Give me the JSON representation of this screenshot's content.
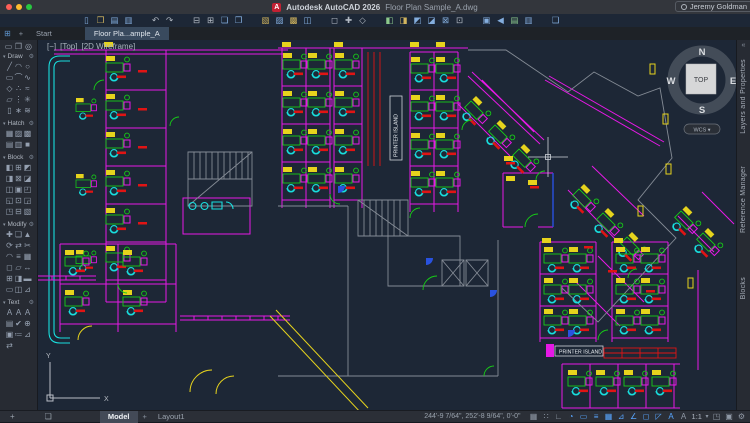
{
  "colors": {
    "titlebar": "#33363c",
    "tabbar": "#1e2227",
    "panel": "#272b33",
    "statusbar": "#2b2f37",
    "canvas": "#1d2736",
    "magenta": "#e619e6",
    "cyan": "#19dede",
    "green": "#17cd17",
    "red": "#e01414",
    "yellow": "#e6d31d",
    "blue": "#2952e0",
    "gray-wall": "#848b95",
    "accent": "#58a6ff"
  },
  "titlebar": {
    "logo_glyph": "A",
    "app_title": "Autodesk AutoCAD 2026",
    "doc_title": "Floor Plan Sample_A.dwg",
    "user": "Jeremy Goldman"
  },
  "quick_toolbar": {
    "icons": [
      {
        "name": "new-file-icon",
        "glyph": "▯",
        "tint": "b"
      },
      {
        "name": "open-folder-icon",
        "glyph": "❒",
        "tint": "y"
      },
      {
        "name": "save-icon",
        "glyph": "▤",
        "tint": "b"
      },
      {
        "name": "save-as-icon",
        "glyph": "▥",
        "tint": "b"
      },
      {
        "name": "undo-icon",
        "glyph": "↶",
        "gap": true
      },
      {
        "name": "redo-icon",
        "glyph": "↷"
      },
      {
        "name": "plot-icon",
        "glyph": "⊟",
        "gap": true
      },
      {
        "name": "plot-preview-icon",
        "glyph": "⊞"
      },
      {
        "name": "publish-icon",
        "glyph": "❏",
        "tint": "b"
      },
      {
        "name": "batch-plot-icon",
        "glyph": "❐",
        "tint": "b"
      },
      {
        "name": "sheet-set-manager-icon",
        "glyph": "▧",
        "tint": "y",
        "gap": true
      },
      {
        "name": "markup-import-icon",
        "glyph": "▨",
        "tint": "b"
      },
      {
        "name": "import-icon",
        "glyph": "▩",
        "tint": "y"
      },
      {
        "name": "export-icon",
        "glyph": "◫",
        "tint": "b"
      },
      {
        "name": "measure-icon",
        "glyph": "◻",
        "gap": true
      },
      {
        "name": "pan-icon",
        "glyph": "✚"
      },
      {
        "name": "orbit-icon",
        "glyph": "◇"
      },
      {
        "name": "layer-properties-icon",
        "glyph": "◧",
        "tint": "g",
        "gap": true
      },
      {
        "name": "layer-state-icon",
        "glyph": "◨",
        "tint": "y"
      },
      {
        "name": "xref-attach-icon",
        "glyph": "◩",
        "tint": "b"
      },
      {
        "name": "block-editor-icon",
        "glyph": "◪",
        "tint": "b"
      },
      {
        "name": "attach-reference-icon",
        "glyph": "⊠",
        "tint": "b"
      },
      {
        "name": "properties-icon",
        "glyph": "⊡"
      },
      {
        "name": "share-drawing-icon",
        "glyph": "▣",
        "tint": "b",
        "gap": true
      },
      {
        "name": "send-icon",
        "glyph": "◀",
        "tint": "b"
      },
      {
        "name": "drawing-compare-icon",
        "glyph": "▤",
        "tint": "g"
      },
      {
        "name": "drawing-history-icon",
        "glyph": "▥",
        "tint": "b"
      },
      {
        "name": "stamp-icon",
        "glyph": "❑",
        "tint": "b",
        "gap": true
      }
    ]
  },
  "tabbar": {
    "menu_glyph": "⊞",
    "plus": "+",
    "start_tab": "Start",
    "doc_tab": "Floor Pla...ample_A"
  },
  "palette": {
    "top_icons": [
      {
        "name": "viewport-icon",
        "glyph": "▭"
      },
      {
        "name": "named-views-icon",
        "glyph": "❐"
      },
      {
        "name": "ucs-settings-icon",
        "glyph": "◎"
      }
    ],
    "sections": [
      {
        "label": "Draw",
        "rows": [
          [
            "╱",
            "◠",
            "○"
          ],
          [
            "▭",
            "⌒",
            "∿"
          ],
          [
            "◇",
            "∴",
            "≈"
          ],
          [
            "▱",
            "⋮",
            "✳"
          ],
          [
            "▯",
            "∗",
            "≋"
          ]
        ]
      },
      {
        "label": "Hatch",
        "rows": [
          [
            "▦",
            "▨",
            "▩"
          ],
          [
            "▤",
            "▥",
            "■"
          ]
        ]
      },
      {
        "label": "Block",
        "rows": [
          [
            "◧",
            "⊞",
            "◩"
          ],
          [
            "◨",
            "⊠",
            "◪"
          ],
          [
            "◫",
            "▣",
            "◰"
          ],
          [
            "◱",
            "⊡",
            "◲"
          ],
          [
            "◳",
            "⊟",
            "▧"
          ]
        ]
      },
      {
        "label": "Modify",
        "rows": [
          [
            "✚",
            "❏",
            "▲"
          ],
          [
            "⟳",
            "⇄",
            "✂"
          ],
          [
            "◠",
            "≡",
            "▦"
          ],
          [
            "◻",
            "▱",
            "↔"
          ],
          [
            "⊞",
            "◨",
            "▬"
          ],
          [
            "▭",
            "◫",
            "⊿"
          ]
        ]
      },
      {
        "label": "Text",
        "rows": [
          [
            "A",
            "A",
            "A"
          ],
          [
            "▤",
            "✔",
            "⊕"
          ],
          [
            "▣",
            "≔",
            "⊿"
          ],
          [
            "⇄",
            "",
            ""
          ]
        ]
      }
    ],
    "header_triangle": "▾",
    "header_gear": "⚙"
  },
  "right_tabs": {
    "collapse_glyph": "«",
    "items": [
      "Layers and Properties",
      "Reference Manager",
      "Blocks"
    ]
  },
  "canvas": {
    "viewport_controls": [
      "[−]",
      "[Top]",
      "[2D Wireframe]"
    ],
    "printer_island_v": "PRINTER ISLAND",
    "printer_island_h": "PRINTER ISLAND",
    "viewcube": {
      "n": "N",
      "e": "E",
      "s": "S",
      "w": "W",
      "top": "TOP",
      "wcs": "WCS ▾"
    },
    "ucs_x": "X",
    "ucs_y": "Y"
  },
  "statusbar": {
    "left_icons": [
      {
        "name": "add-tool-icon",
        "glyph": "+"
      },
      {
        "name": "palette-icon",
        "glyph": "❏"
      }
    ],
    "model_tab": "Model",
    "plus": "+",
    "layout_tab": "Layout1",
    "coords": "244'-9 7/64\", 252'-8 9/64\", 0'-0\"",
    "icons": [
      {
        "name": "model-paper-toggle-icon",
        "glyph": "▦"
      },
      {
        "name": "grid-display-icon",
        "glyph": "∷"
      },
      {
        "name": "snap-mode-icon",
        "glyph": "∟"
      },
      {
        "name": "selection-cycling-icon",
        "glyph": "◔",
        "on": true
      },
      {
        "name": "dynamic-input-icon",
        "glyph": "▭",
        "on": true
      },
      {
        "name": "lineweight-icon",
        "glyph": "≡",
        "on": true
      },
      {
        "name": "transparency-icon",
        "glyph": "▦",
        "on": true
      },
      {
        "name": "object-snap-tracking-icon",
        "glyph": "⊿",
        "on": true
      },
      {
        "name": "polar-tracking-icon",
        "glyph": "∠",
        "on": true
      },
      {
        "name": "object-snap-icon",
        "glyph": "◻",
        "on": true
      },
      {
        "name": "3d-object-snap-icon",
        "glyph": "◸",
        "on": true
      },
      {
        "name": "annotation-visibility-icon",
        "glyph": "A",
        "on": true
      },
      {
        "name": "annotation-autoscale-icon",
        "glyph": "A"
      }
    ],
    "scale": "1:1",
    "scale_caret": "▾",
    "tail_icons": [
      {
        "name": "workspace-switching-icon",
        "glyph": "◳"
      },
      {
        "name": "annotation-monitor-icon",
        "glyph": "▣"
      },
      {
        "name": "customization-gear-icon",
        "glyph": "⚙"
      }
    ]
  }
}
